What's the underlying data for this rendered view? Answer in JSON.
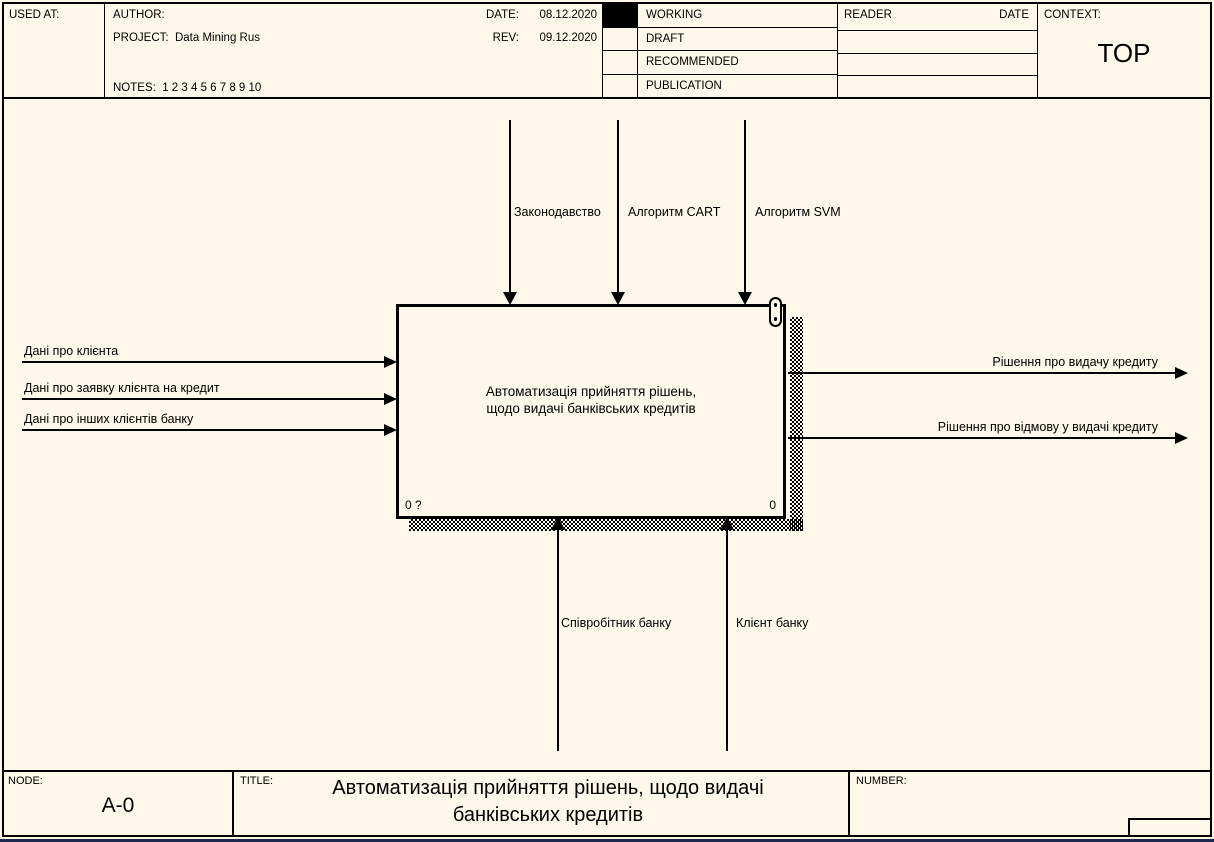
{
  "header": {
    "used_at_label": "USED AT:",
    "author_label": "AUTHOR:",
    "project_label": "PROJECT:",
    "project_value": "Data Mining Rus",
    "notes_label": "NOTES:",
    "notes_value": "1 2 3 4 5 6 7 8 9 10",
    "date_label": "DATE:",
    "date_value": "08.12.2020",
    "rev_label": "REV:",
    "rev_value": "09.12.2020",
    "statuses": [
      "WORKING",
      "DRAFT",
      "RECOMMENDED",
      "PUBLICATION"
    ],
    "checked_status": "WORKING",
    "reader_label": "READER",
    "reader_date_label": "DATE",
    "context_label": "CONTEXT:",
    "context_value": "TOP"
  },
  "diagram": {
    "activity_box": {
      "title_line1": "Автоматизація прийняття рішень,",
      "title_line2": "щодо видачі банківських кредитів",
      "corner_left": "0 ?",
      "corner_right": "0"
    },
    "inputs": [
      "Дані про клієнта",
      "Дані про заявку клієнта на кредит",
      "Дані про інших клієнтів банку"
    ],
    "controls": [
      "Законодавство",
      "Алгоритм CART",
      "Алгоритм SVM"
    ],
    "outputs": [
      "Рішення про видачу кредиту",
      "Рішення про відмову у видачі кредиту"
    ],
    "mechanisms": [
      "Співробітник банку",
      "Клієнт банку"
    ]
  },
  "footer": {
    "node_label": "NODE:",
    "node_value": "A-0",
    "title_label": "TITLE:",
    "title_value": "Автоматизація прийняття рішень, щодо видачі банківських кредитів",
    "number_label": "NUMBER:"
  },
  "colors": {
    "background": "#fdf8e9",
    "line": "#000000",
    "checked_box": "#000000",
    "bottom_strip": "#1e2950"
  }
}
